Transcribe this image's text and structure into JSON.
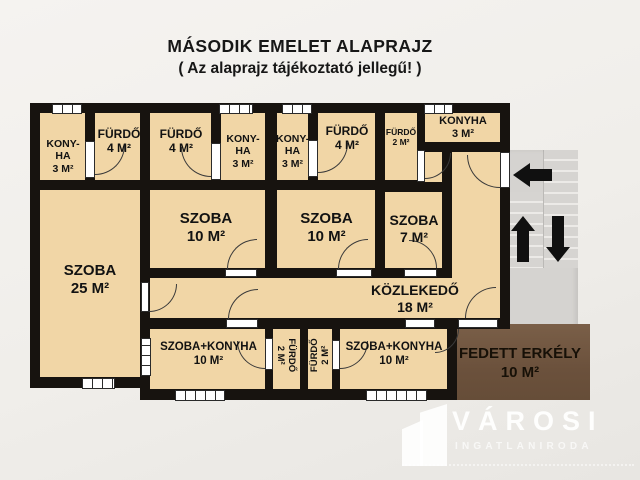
{
  "title": {
    "line1": "MÁSODIK EMELET ALAPRAJZ",
    "line2": "( Az alaprajz tájékoztató jellegű! )"
  },
  "rooms": {
    "konyha1": {
      "label": "KONY-\nHA",
      "area": "3 M²"
    },
    "furdo1": {
      "label": "FÜRDŐ",
      "area": "4 M²"
    },
    "furdo2": {
      "label": "FÜRDŐ",
      "area": "4 M²"
    },
    "konyha2": {
      "label": "KONY-\nHA",
      "area": "3 M²"
    },
    "konyha3": {
      "label": "KONY-\nHA",
      "area": "3 M²"
    },
    "furdo3": {
      "label": "FÜRDŐ",
      "area": "4 M²"
    },
    "furdo4": {
      "label": "FÜRDŐ",
      "area": "2 M²"
    },
    "konyha4": {
      "label": "KONYHA",
      "area": "3 M²"
    },
    "szoba25": {
      "label": "SZOBA",
      "area": "25 M²"
    },
    "szoba10a": {
      "label": "SZOBA",
      "area": "10 M²"
    },
    "szoba10b": {
      "label": "SZOBA",
      "area": "10 M²"
    },
    "szoba7": {
      "label": "SZOBA",
      "area": "7 M²"
    },
    "kozlekedo": {
      "label": "KÖZLEKEDŐ",
      "area": "18 M²"
    },
    "szobakonyha1": {
      "label": "SZOBA+KONYHA",
      "area": "10 M²"
    },
    "furdo5": {
      "label": "FÜRDŐ",
      "area": "2 M²"
    },
    "furdo6": {
      "label": "FÜRDŐ",
      "area": "2 M²"
    },
    "szobakonyha2": {
      "label": "SZOBA+KONYHA",
      "area": "10 M²"
    },
    "erkely": {
      "label": "FEDETT ERKÉLY",
      "area": "10 M²"
    }
  },
  "stairwell": {
    "icons": [
      "arrow-left",
      "arrow-up",
      "arrow-down"
    ]
  },
  "logo": {
    "brand": "VÁROSI",
    "subtitle": "INGATLANIRODA"
  },
  "colors": {
    "room_fill": "#f1d6a6",
    "wall": "#17130f",
    "balcony": "#6e543d",
    "stairs": "#d5d3d0",
    "background": "#f0eeea"
  }
}
